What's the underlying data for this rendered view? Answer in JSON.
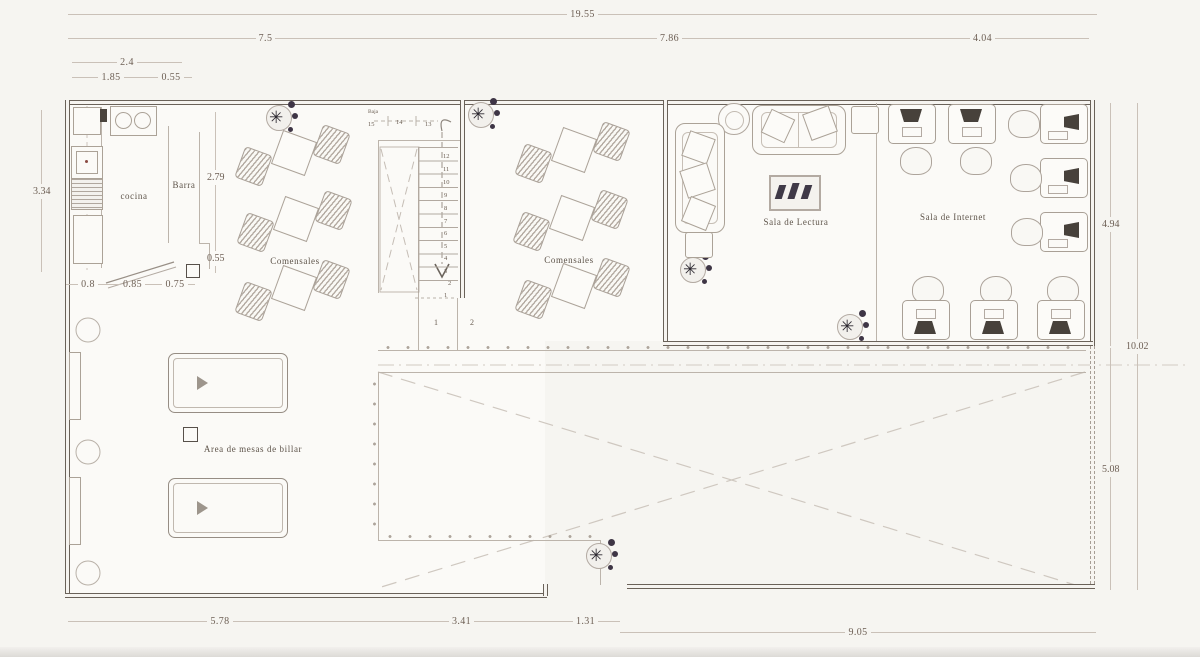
{
  "rooms": {
    "kitchen": "cocina",
    "bar": "Barra",
    "dining_left": "Comensales",
    "dining_center": "Comensales",
    "reading_room": "Sala de Lectura",
    "internet_room": "Sala de Internet",
    "billiards_area": "Area de mesas de billar"
  },
  "stairs": {
    "direction_label": "Baja",
    "landing_numbers": [
      "15",
      "14",
      "13"
    ],
    "run_numbers": [
      "12",
      "11",
      "10",
      "9",
      "8",
      "7",
      "6",
      "5",
      "4",
      "3",
      "2"
    ],
    "lower_number": "1",
    "floor_numbers": [
      "1",
      "2"
    ]
  },
  "dimensions": {
    "top_total": "19.55",
    "top_seg_left": "7.5",
    "top_seg_mid": "7.86",
    "top_seg_right": "4.04",
    "sub_total": "2.4",
    "sub_left": "1.85",
    "sub_right": "0.55",
    "left_height": "3.34",
    "bar_height": "2.79",
    "bar_lower": "0.55",
    "kitchen_seg_1": "0.8",
    "kitchen_seg_2": "0.85",
    "kitchen_seg_3": "0.75",
    "right_upper": "4.94",
    "right_total": "10.02",
    "right_lower": "5.08",
    "bottom_seg_1": "5.78",
    "bottom_seg_2": "3.41",
    "bottom_entrance": "1.31",
    "bottom_right": "9.05"
  },
  "colors": {
    "wall": "#6a6259",
    "light_line": "#bcb4ab",
    "dimension_text": "#6d5f54",
    "plant_foliage": "#3e3545",
    "monitor": "#47413b"
  }
}
